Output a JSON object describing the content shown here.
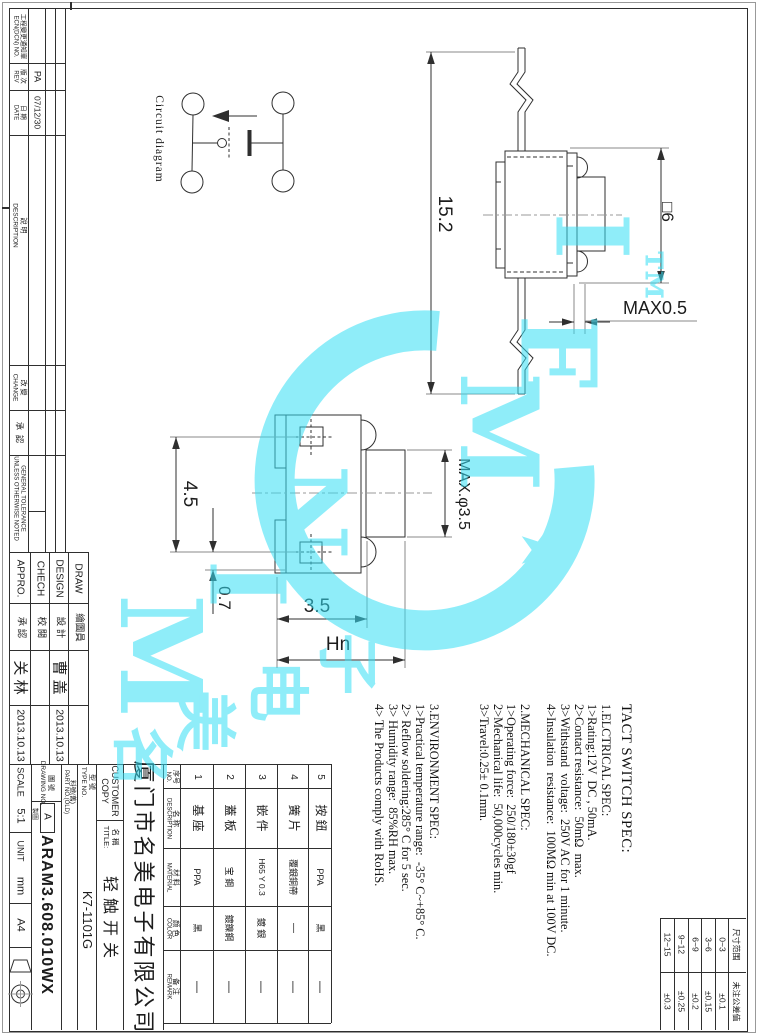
{
  "circuit_label": "Circuit diagram",
  "dims": {
    "side_height": "15.2",
    "side_width": "□6",
    "lead_max": "MAX0.5",
    "pitch": "4.5",
    "edge": "0.7",
    "body_w": "3.5",
    "total_w": "Hn",
    "stem": "MAX.φ3.5"
  },
  "spec": {
    "lines": [
      "TACT SWITCH SPEC:",
      "1.ELCTRICAL SPEC:",
      "1>Rating:12V  DC , 50mA.",
      "2>Contact resistance:  50mΩ  max.",
      "3>Withstand  voltage:  250V AC for 1 minute.",
      "4>Insulation  resistance:  100MΩ min at 100V DC.",
      "2.MECHANICAL SPEC:",
      "1>Operating force:  250/180±30gf",
      "2>Mechanical life:  50,000cycles min.",
      "3>Travel:0.25± 0.1mm.",
      "3.ENVIRONMENT SPEC:",
      "1>Practical temperature range:  -35° C~+85° C.",
      "2> Reflow soldering:285° C for 5 sec.",
      "3> Humidity range:  85%RH max.",
      "4> The Products comply with RoHS."
    ]
  },
  "revision_strip": {
    "ecn_cn": "工程變更通知單",
    "ecn_en": "ECN(DCN) NO.",
    "rev_cn": "版 次",
    "rev_en": "REV",
    "rev_value": "PA",
    "date_cn": "日 期",
    "date_en": "DATE",
    "date_value": "07/12/30",
    "desc_cn": "說 明",
    "desc_en": "DESCRIPTION",
    "change_cn": "改 變",
    "change_en": "CHANGE",
    "approve_cn": "承  認",
    "tolerance_l1": "GENERAL TOLERANCE",
    "tolerance_l2": "UNLESS OTHERWISE NOTED"
  },
  "approval": {
    "columns": [
      {
        "en": "APPRO.",
        "cn": "承 認",
        "name": "关 林",
        "date": "2013.10.13"
      },
      {
        "en": "CHECH",
        "cn": "校 閱",
        "name": "",
        "date": ""
      },
      {
        "en": "DESIGN",
        "cn": "設 計",
        "name": "曹 盖",
        "date": "2013.10.13"
      },
      {
        "en": "DRAW",
        "cn": "繪圖員",
        "name": "",
        "date": ""
      }
    ]
  },
  "title_block": {
    "scale_label": "SCALE",
    "scale_value": "5:1",
    "unit_label": "UNIT",
    "unit_value": "mm",
    "size": "A4",
    "drawing_no_cn": "圖 號",
    "drawing_no_en": "DRAWING NO.",
    "rev_letter": "A",
    "tiny_note": "製圖",
    "drawing_no_value": "ARAM3.608.010WX",
    "part_no_cn": "料號(舊)",
    "part_no_en": "PART NO.(OLD)",
    "type_no_cn": "型 號",
    "type_no_en": "TYPE NO.",
    "type_no_value": "K7-1101G",
    "customer_l1": "CUSTOMER",
    "customer_l2": "COPY",
    "title_cn": "名 稱",
    "title_en": "TITLE:",
    "title_value": "轻触开关",
    "company": "厦门市名美电子有限公司"
  },
  "parts_table": {
    "header": {
      "no_cn": "序号",
      "no_en": "NO.",
      "name_cn": "名 称",
      "name_en": "DESCRIPTION",
      "material_cn": "材 料",
      "material_en": "MATERIAL",
      "color_cn": "颜 色",
      "color_en": "COLOR",
      "remark_cn": "备 注",
      "remark_en": "REMARK"
    },
    "rows": [
      {
        "no": "1",
        "name": "基 座",
        "material": "PPA",
        "color": "黑",
        "remark": "—"
      },
      {
        "no": "2",
        "name": "蓋 板",
        "material": "宝 鋼",
        "color": "鍍鎳鋼",
        "remark": "—"
      },
      {
        "no": "3",
        "name": "嵌 件",
        "material": "H65 Y 0.3",
        "color": "鍍 銀",
        "remark": "—"
      },
      {
        "no": "4",
        "name": "簧 片",
        "material": "覆銀銅帶",
        "color": "—",
        "remark": "—"
      },
      {
        "no": "5",
        "name": "按 鈕",
        "material": "PPA",
        "color": "黑",
        "remark": "—"
      }
    ]
  },
  "tolerance_table": {
    "range_header": "尺寸范围",
    "tol_header": "未注公差值",
    "rows": [
      {
        "range": "0~3",
        "tol": "±0.1"
      },
      {
        "range": "3~6",
        "tol": "±0.15"
      },
      {
        "range": "6~9",
        "tol": "±0.2"
      },
      {
        "range": "9~12",
        "tol": "±0.25"
      },
      {
        "range": "12~15",
        "tol": "±0.3"
      }
    ]
  },
  "watermark": {
    "word1_0": "M",
    "word1_1": "I",
    "word1_2": "N",
    "word2_0": "M",
    "word2_1": "E",
    "word2_2": "I",
    "tm": "™",
    "star": "★",
    "cn_0": "名",
    "cn_1": "美",
    "cn_2": "电",
    "cn_3": "子",
    "color": "#35dff5"
  }
}
